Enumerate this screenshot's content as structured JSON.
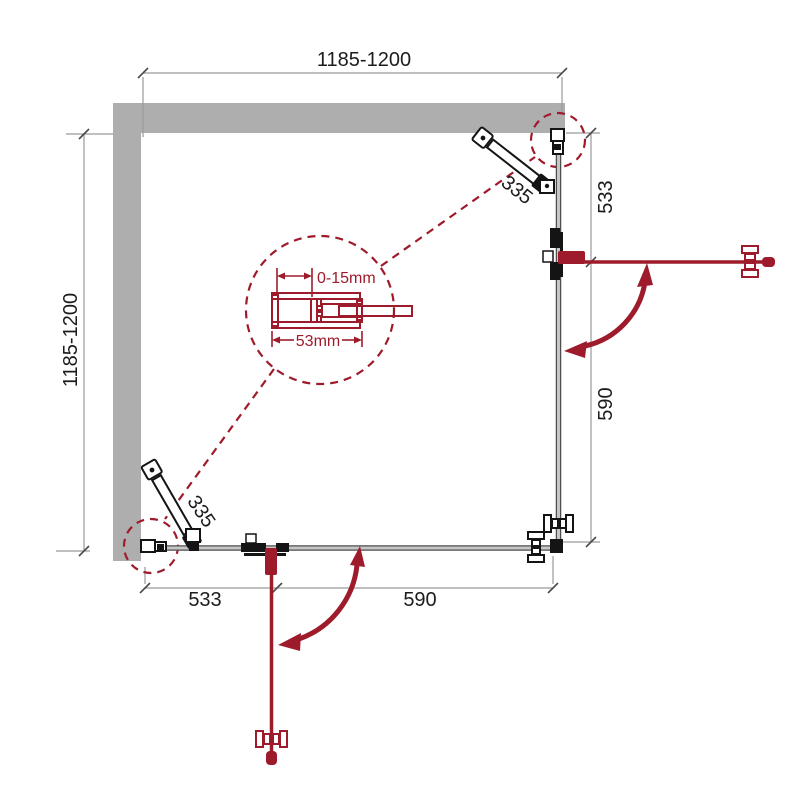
{
  "colors": {
    "accent": "#9e1b2b",
    "wall": "#aeaeae",
    "glassEdge": "#4f4f4f",
    "glassFill": "#c6c6c6",
    "dimLine": "#9a9a9a",
    "text": "#1c1c1c",
    "hardware": "#141414",
    "bg": "#ffffff"
  },
  "labels": {
    "width_top": "1185-1200",
    "height_left": "1185-1200",
    "right_upper_segment": "533",
    "right_lower_segment": "590",
    "bottom_left_segment": "533",
    "bottom_right_segment": "590",
    "support_bar_top": "335",
    "support_bar_bottom": "335"
  },
  "detail": {
    "adjustment_range": "0-15mm",
    "profile_width": "53mm"
  }
}
